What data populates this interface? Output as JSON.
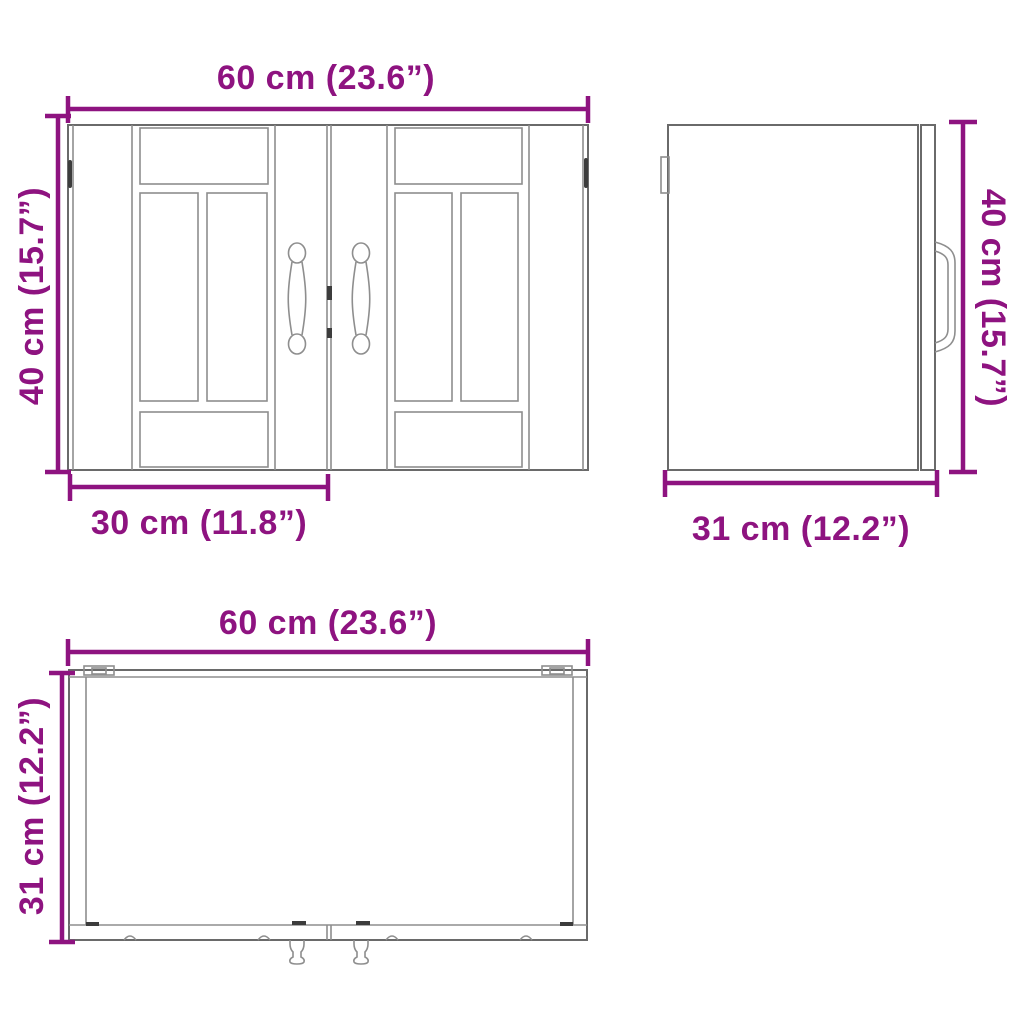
{
  "colors": {
    "dimension": "#8E1380",
    "outline": "#8E8E8E",
    "outline_strong": "#6A6A6A",
    "outline_dark": "#3C3C3C"
  },
  "views": {
    "front": {
      "width_label": "60 cm (23.6”)",
      "height_label": "40 cm (15.7”)",
      "door_width_label": "30 cm (11.8”)"
    },
    "side": {
      "height_label": "40 cm (15.7”)",
      "depth_label": "31 cm (12.2”)"
    },
    "top": {
      "width_label": "60 cm (23.6”)",
      "depth_label": "31 cm (12.2”)"
    }
  }
}
